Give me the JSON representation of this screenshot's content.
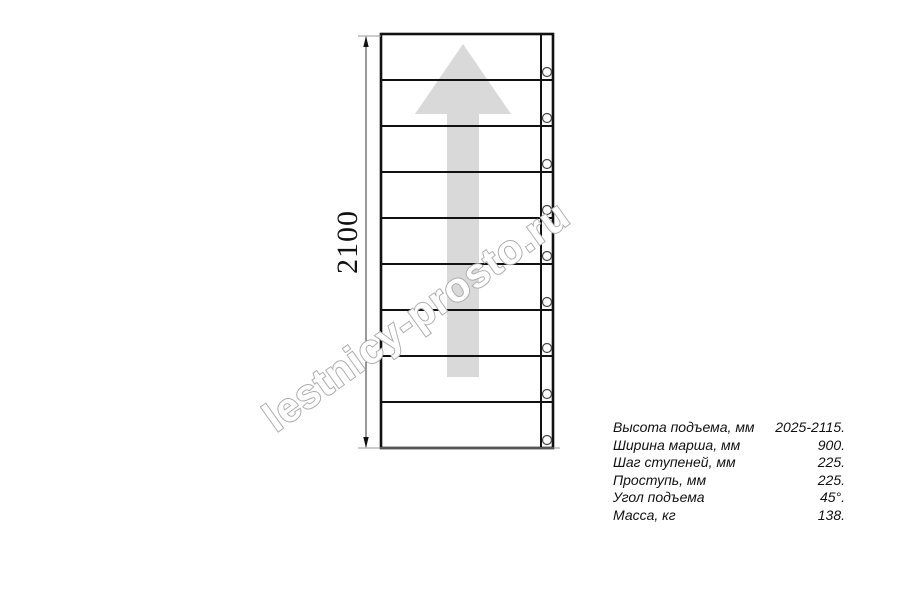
{
  "page": {
    "background": "#ffffff"
  },
  "watermark": {
    "text": "lestnicy-prosto.ru",
    "stroke_color": "#adadad",
    "fill_color": "#ffffff"
  },
  "drawing": {
    "type": "staircase-top-view",
    "dimension_label": "2100",
    "steps": 9,
    "arrow_color": "#d9d9d9",
    "line_color": "#111111",
    "extension_line_color": "#999999"
  },
  "specs": {
    "rows": [
      {
        "label": "Высота подъема, мм",
        "value": "2025-2115."
      },
      {
        "label": "Ширина марша, мм",
        "value": "900."
      },
      {
        "label": "Шаг ступеней, мм",
        "value": "225."
      },
      {
        "label": "Проступь, мм",
        "value": "225."
      },
      {
        "label": "Угол подъема",
        "value": "45°."
      },
      {
        "label": "Масса, кг",
        "value": "138."
      }
    ]
  }
}
